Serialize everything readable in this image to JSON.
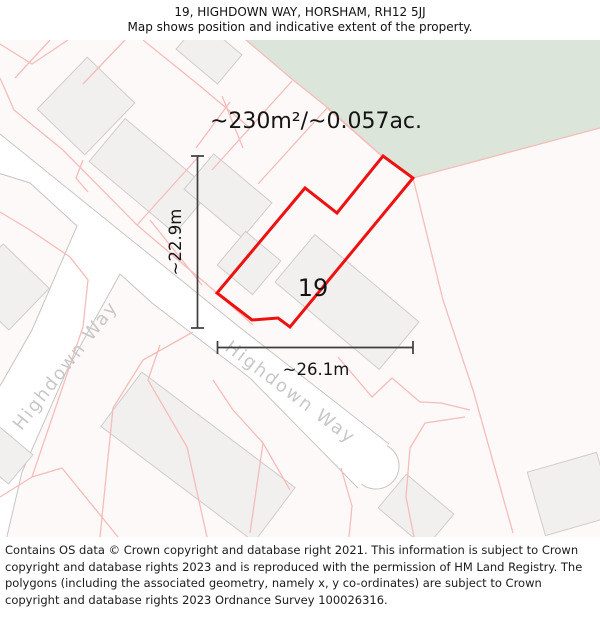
{
  "header": {
    "title": "19, HIGHDOWN WAY, HORSHAM, RH12 5JJ",
    "subtitle": "Map shows position and indicative extent of the property."
  },
  "map": {
    "area_label": "~230m²/~0.057ac.",
    "plot_number": "19",
    "width_label": "~26.1m",
    "height_label": "~22.9m",
    "street_name": "Highdown Way",
    "street_name_2": "Highdown Way"
  },
  "footer": {
    "text": "Contains OS data © Crown copyright and database right 2021. This information is subject to Crown copyright and database rights 2023 and is reproduced with the permission of HM Land Registry. The polygons (including the associated geometry, namely x, y co-ordinates) are subject to Crown copyright and database rights 2023 Ordnance Survey 100026316."
  },
  "colors": {
    "map_bg": "#fcf9f8",
    "road_fill": "#ffffff",
    "road_edge": "#c7c5c5",
    "green_area": "#dce5da",
    "pink_parcel": "#f6bcb9",
    "building_fill": "#f1f0ef",
    "building_stroke": "#cfcccc",
    "red_outline": "#ee1111",
    "street_text": "#c9c7c7",
    "measure": "#3d3d3d",
    "label_text": "#141414"
  }
}
